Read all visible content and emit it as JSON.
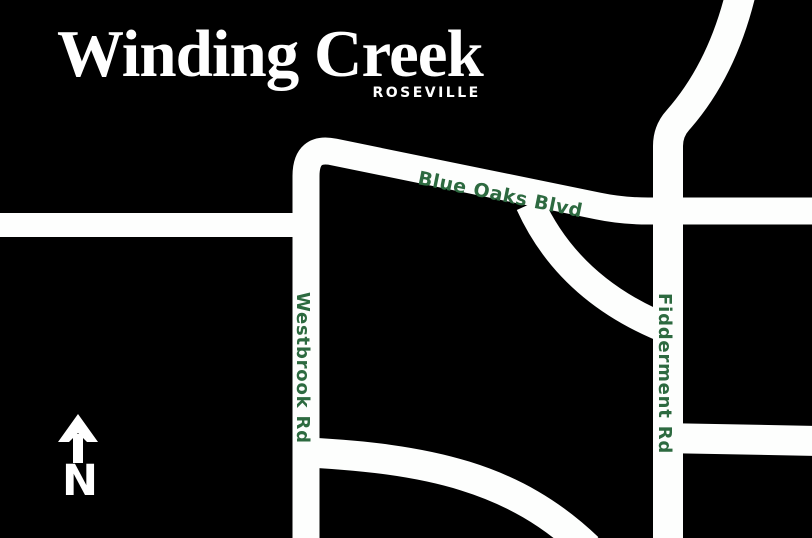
{
  "title": {
    "name": "Winding Creek",
    "location": "ROSEVILLE"
  },
  "map": {
    "background_color": "#000000",
    "road_color": "#fdfefd",
    "label_color": "#2d6a40",
    "roads": [
      {
        "id": "blue-oaks-blvd",
        "label": "Blue Oaks Blvd",
        "orientation": "diagonal-east-west"
      },
      {
        "id": "westbrook-rd",
        "label": "Westbrook Rd",
        "orientation": "north-south"
      },
      {
        "id": "fidderment-rd",
        "label": "Fidderment Rd",
        "orientation": "north-south"
      }
    ]
  },
  "compass": {
    "label": "N",
    "direction": "north"
  }
}
